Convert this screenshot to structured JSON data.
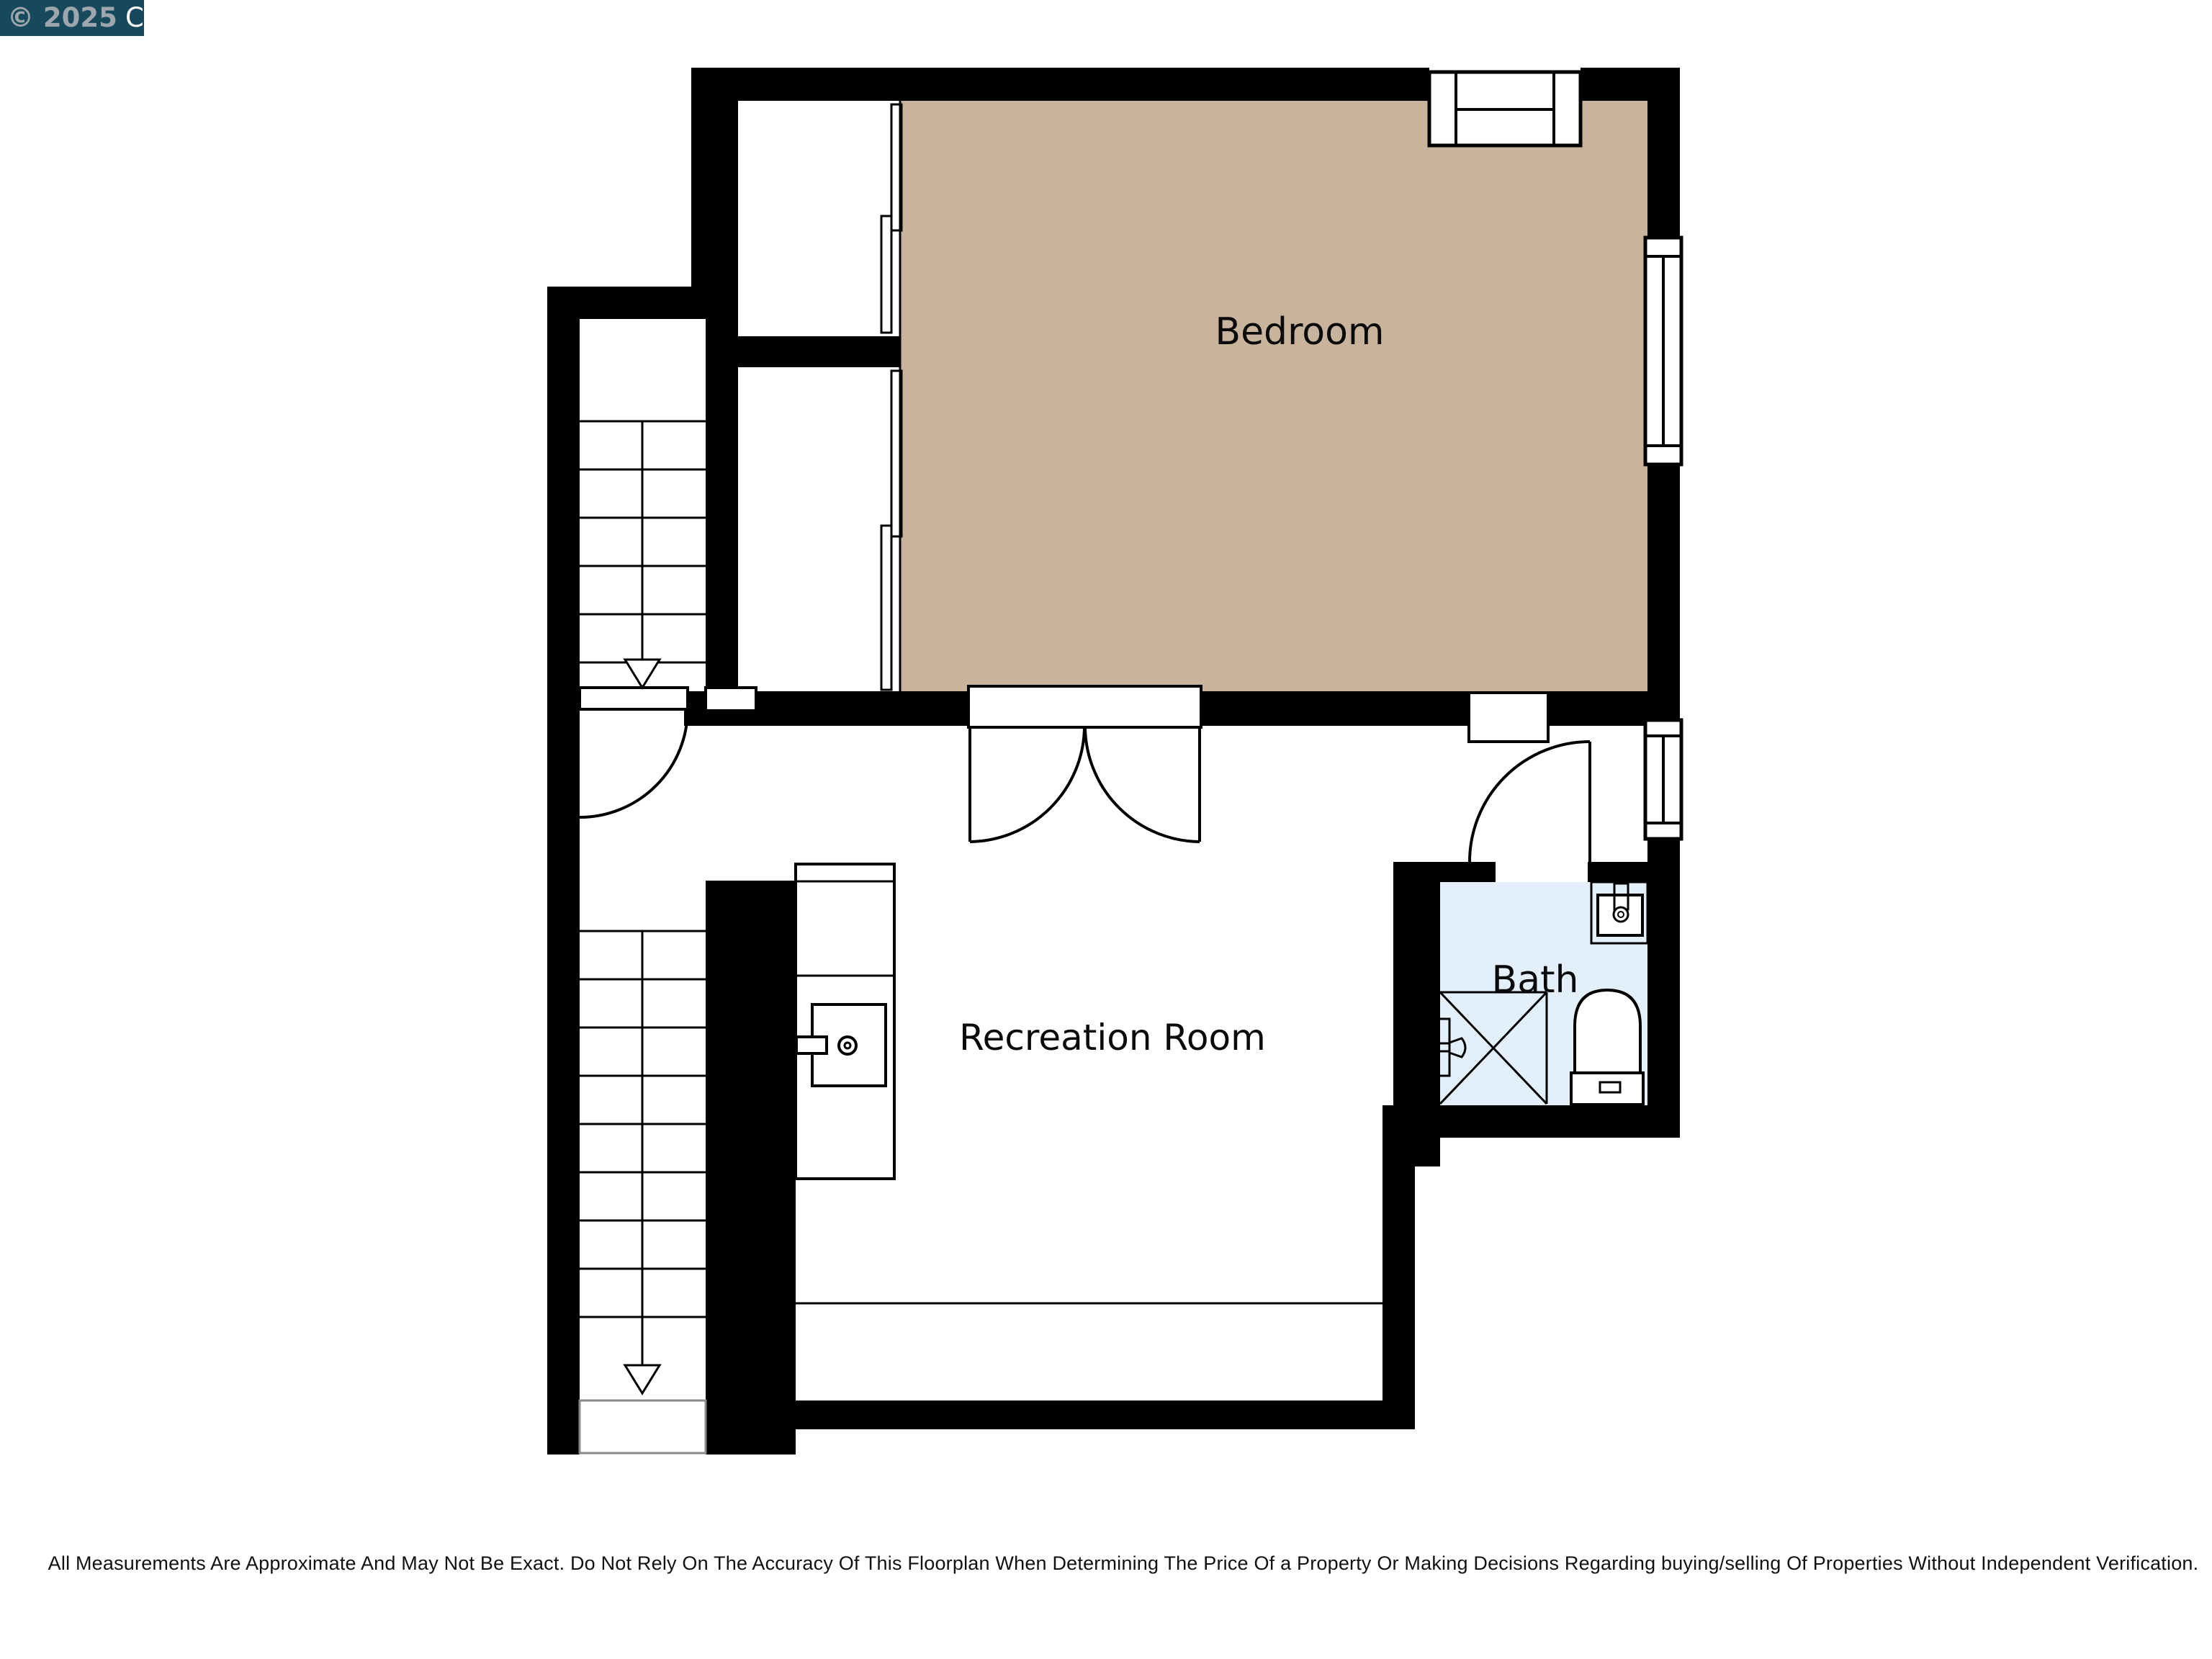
{
  "badge": {
    "copyright": "© 2025",
    "org": "CCAR",
    "bg": "#17495C",
    "copyright_color": "#9EA6AD",
    "org_color": "#FFFFFF"
  },
  "rooms": {
    "bedroom": {
      "label": "Bedroom",
      "fill": "#C8B39C"
    },
    "recreation": {
      "label": "Recreation Room",
      "fill": "#FFFFFF"
    },
    "bath": {
      "label": "Bath",
      "fill": "#E3F0FB"
    }
  },
  "colors": {
    "wall": "#000000",
    "line": "#000000"
  },
  "icons": {
    "stair_direction_upper": "down-arrow-icon",
    "stair_direction_lower": "down-arrow-icon"
  },
  "disclaimer": "All Measurements Are Approximate And May Not Be Exact. Do Not Rely On The Accuracy Of This Floorplan When Determining The Price Of a Property Or Making Decisions Regarding buying/selling Of Properties Without Independent Verification."
}
